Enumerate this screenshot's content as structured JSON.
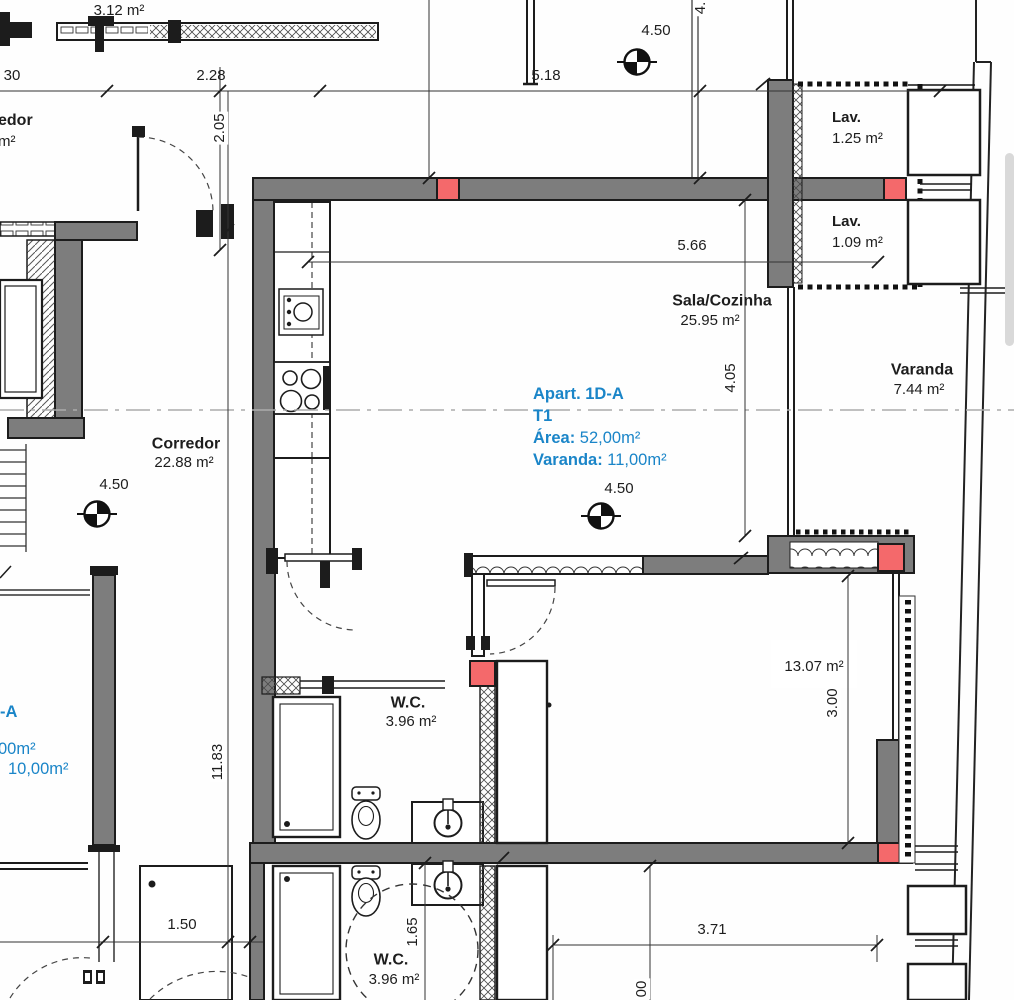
{
  "colors": {
    "wall_gray": "#7d7d7d",
    "column_red": "#f4696b",
    "line_black": "#1c1c1c",
    "info_blue": "#1a85c8",
    "centerline_gray": "#ababab",
    "scrollbar_gray": "#d9d9d9"
  },
  "rooms": {
    "neighbor_area_top": "3.12 m²",
    "corridor_cut": {
      "line1": "edor",
      "line2": "m²"
    },
    "sala": {
      "name": "Sala/Cozinha",
      "area": "25.95 m²"
    },
    "lav_upper": {
      "name": "Lav.",
      "area": "1.25 m²"
    },
    "lav_lower": {
      "name": "Lav.",
      "area": "1.09 m²"
    },
    "varanda": {
      "name": "Varanda",
      "area": "7.44 m²"
    },
    "corredor": {
      "name": "Corredor",
      "area": "22.88 m²"
    },
    "quarto": {
      "area": "13.07 m²"
    },
    "wc_upper": {
      "name": "W.C.",
      "area": "3.96 m²"
    },
    "wc_lower": {
      "name": "W.C.",
      "area": "3.96 m²"
    }
  },
  "info_block": {
    "title": "Apart. 1D-A",
    "typology": "T1",
    "area_label": "Área:",
    "area_value": "52,00m²",
    "varanda_label": "Varanda:",
    "varanda_value": "11,00m²"
  },
  "info_block_cut": {
    "line1": "-A",
    "line2": "00m²",
    "line3": "10,00m²"
  },
  "level_marker": "4.50",
  "dims": {
    "cut_top_left": "30",
    "w_2_28": "2.28",
    "w_5_18": "5.18",
    "h_2_05": "2.05",
    "w_5_66": "5.66",
    "h_4_05": "4.05",
    "h_11_83": "11.83",
    "w_1_50": "1.50",
    "h_1_65": "1.65",
    "w_3_71": "3.71",
    "h_3_00": "3.00",
    "cut_bottom": "00",
    "cut_top_right": "4."
  }
}
